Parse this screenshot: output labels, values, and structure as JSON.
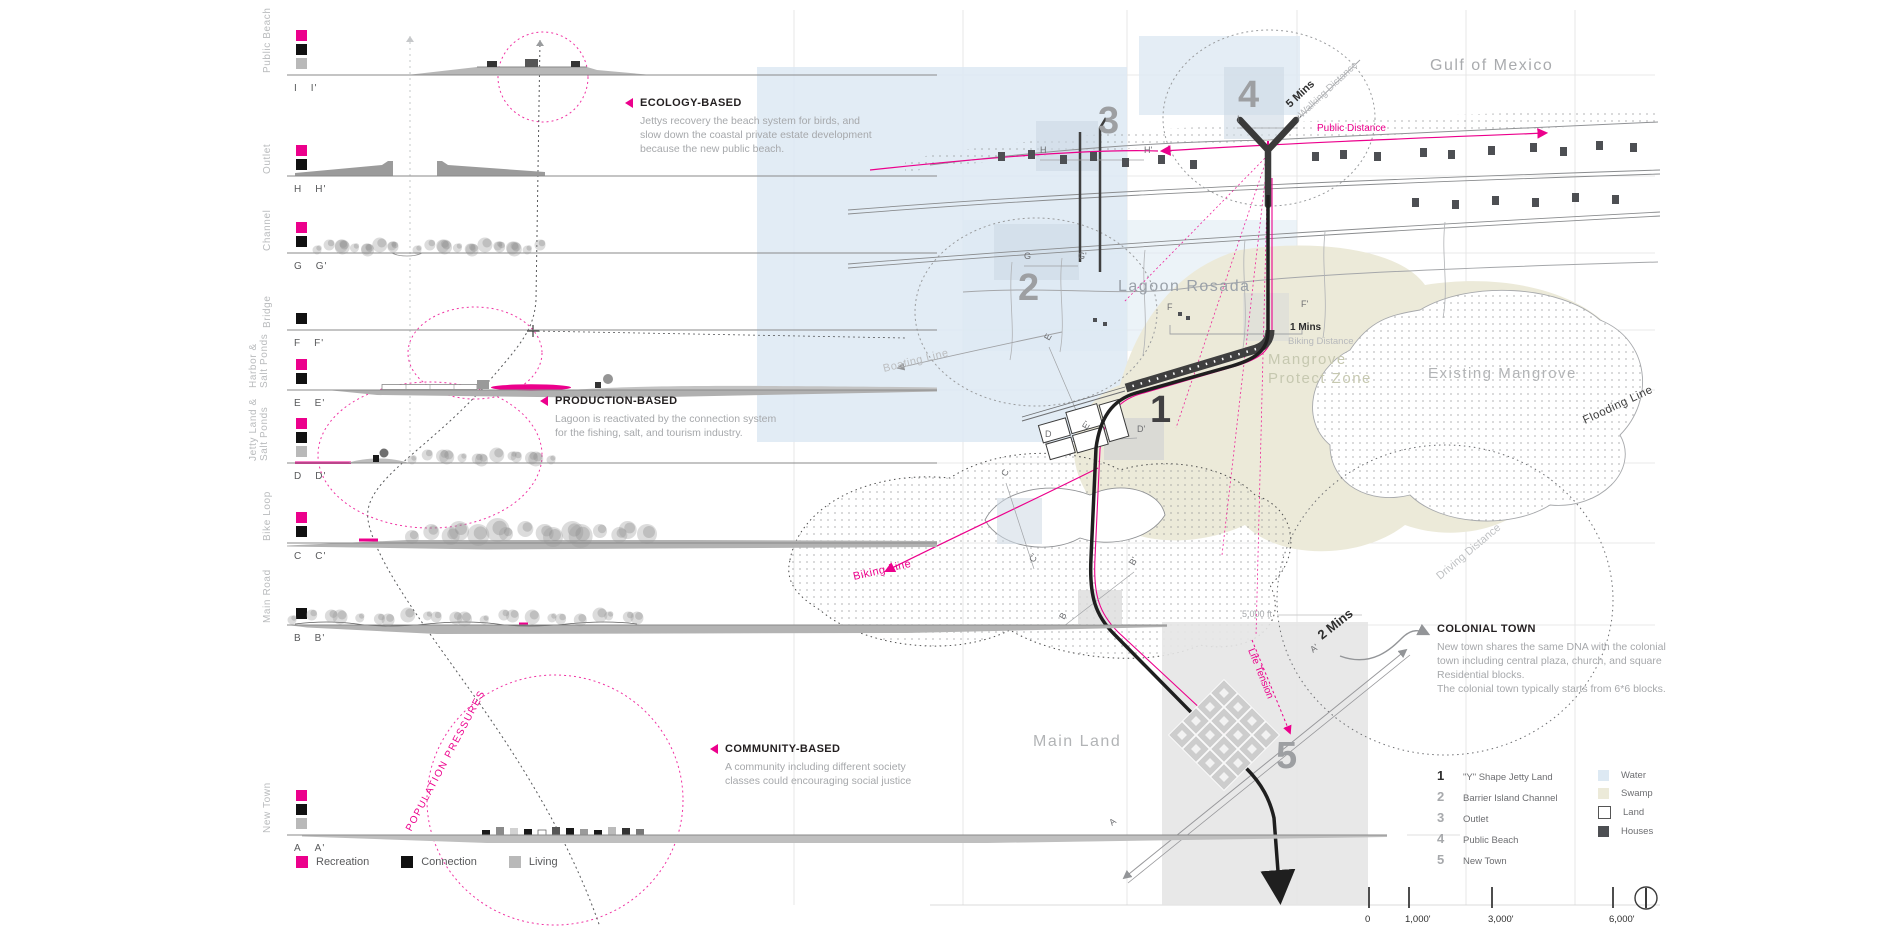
{
  "palette": {
    "pink": "#ec008c",
    "water": "#dde9f3",
    "swamp": "#ecead9",
    "land_box": "#e6e6e6",
    "house": "#4d4f53",
    "ink": "#2d2d2d",
    "number_gray": "#9d9fa2"
  },
  "sections": [
    {
      "name": "Public Beach",
      "start": "I",
      "end": "I'",
      "programs": [
        "recreation",
        "connection",
        "living"
      ]
    },
    {
      "name": "Outlet",
      "start": "H",
      "end": "H'",
      "programs": [
        "recreation",
        "connection"
      ]
    },
    {
      "name": "Channel",
      "start": "G",
      "end": "G'",
      "programs": [
        "recreation",
        "connection"
      ]
    },
    {
      "name": "Bridge",
      "start": "F",
      "end": "F'",
      "programs": [
        "connection"
      ]
    },
    {
      "name": "Harbor &\nSalt Ponds",
      "start": "E",
      "end": "E'",
      "programs": [
        "recreation",
        "connection"
      ]
    },
    {
      "name": "Jetty Land &\nSalt Ponds",
      "start": "D",
      "end": "D'",
      "programs": [
        "recreation",
        "connection",
        "living"
      ]
    },
    {
      "name": "Bike Loop",
      "start": "C",
      "end": "C'",
      "programs": [
        "recreation",
        "connection"
      ]
    },
    {
      "name": "Main Road",
      "start": "B",
      "end": "B'",
      "programs": [
        "connection"
      ]
    },
    {
      "name": "New Town",
      "start": "A",
      "end": "A'",
      "programs": [
        "recreation",
        "connection",
        "living"
      ]
    }
  ],
  "program_legend": [
    {
      "key": "recreation",
      "label": "Recreation",
      "color": "#ec008c"
    },
    {
      "key": "connection",
      "label": "Connection",
      "color": "#111111"
    },
    {
      "key": "living",
      "label": "Living",
      "color": "#b9b9b9"
    }
  ],
  "annotations": {
    "ecology": {
      "title": "ECOLOGY-BASED",
      "body": "Jettys recovery the beach system for birds, and\nslow down the coastal private estate development\nbecause the new  public beach."
    },
    "production": {
      "title": "PRODUCTION-BASED",
      "body": "Lagoon is reactivated by the connection system\nfor the fishing, salt, and tourism industry."
    },
    "community": {
      "title": "COMMUNITY-BASED",
      "body": "A community including different society\nclasses could encouraging social justice"
    },
    "colonial": {
      "title": "COLONIAL TOWN",
      "body": "New town shares the same DNA with the colonial\ntown including central plaza, church, and square\nResidential blocks.\nThe colonial town typically starts from 6*6 blocks."
    }
  },
  "population_pressures": "POPULATION PRESSURES",
  "plan": {
    "labels": {
      "gulf": "Gulf of Mexico",
      "lagoon": "Lagoon Rosada",
      "mangrove_zone_1": "Mangrove",
      "mangrove_zone_2": "Protect Zone",
      "existing_mangrove": "Existing Mangrove",
      "main_land": "Main Land",
      "flooding": "Flooding Line",
      "driving": "Driving Distance",
      "boating": "Boating Line",
      "biking_line": "Biking Line",
      "public_distance": "Public Distance",
      "walking_time": "5 Mins",
      "walking": "Walking Distance",
      "biking_time": "1 Mins",
      "biking": "Biking Distance",
      "driving_time": "2 Mins",
      "life_tension": "Life Tension",
      "dist_5000": "5,000 ft"
    },
    "numbers": [
      "1",
      "2",
      "3",
      "4",
      "5"
    ],
    "markers": [
      "I",
      "I'",
      "H",
      "H'",
      "G",
      "G'",
      "F",
      "F'",
      "E",
      "E'",
      "D",
      "D'",
      "C",
      "C'",
      "B",
      "B'",
      "A",
      "A'"
    ]
  },
  "plan_legend": {
    "items": [
      {
        "num": "1",
        "label": "\"Y\" Shape Jetty Land"
      },
      {
        "num": "2",
        "label": "Barrier Island Channel"
      },
      {
        "num": "3",
        "label": "Outlet"
      },
      {
        "num": "4",
        "label": "Public Beach"
      },
      {
        "num": "5",
        "label": "New Town"
      }
    ],
    "areas": [
      {
        "label": "Water",
        "color": "#dde9f3"
      },
      {
        "label": "Swamp",
        "color": "#ecead9"
      },
      {
        "label": "Land",
        "color": "#ffffff"
      },
      {
        "label": "Houses",
        "color": "#4d4f53"
      }
    ]
  },
  "scale_bar": {
    "ticks": [
      "0",
      "1,000'",
      "3,000'",
      "6,000'"
    ]
  }
}
